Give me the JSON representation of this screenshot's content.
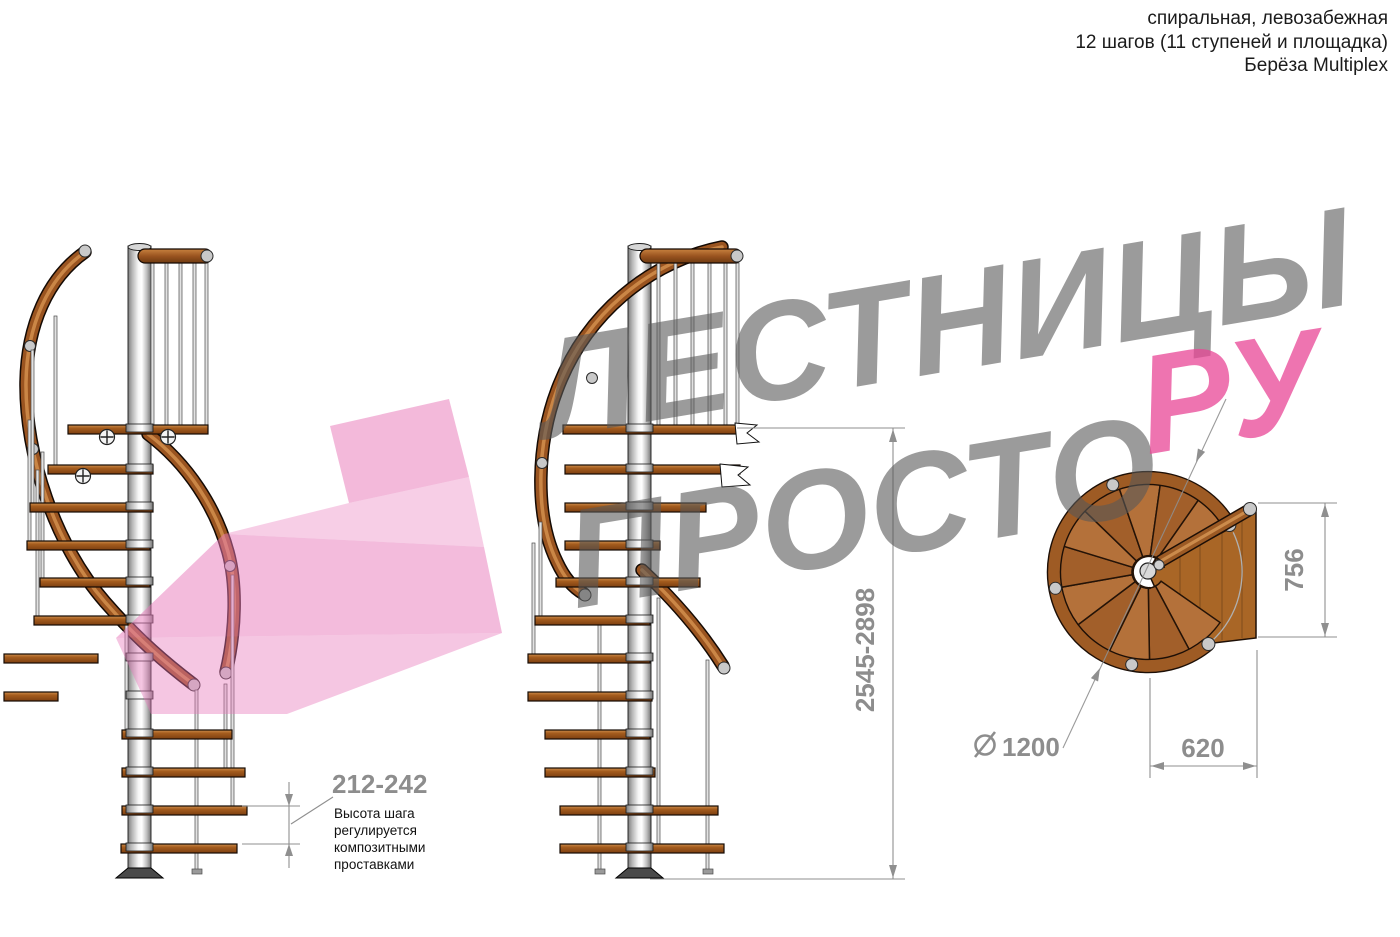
{
  "page": {
    "width": 1400,
    "height": 937,
    "background": "#ffffff"
  },
  "header": {
    "lines": [
      "спиральная, левозабежная",
      "12 шагов (11 ступеней и площадка)",
      "Берёза Multiplex"
    ]
  },
  "watermark": {
    "word1": "ЛЕСТНИЦЫ",
    "word2": "ПРОСТО",
    "word3": "РУ",
    "gray_color": "#9a9a9a",
    "pink_color": "#ee58a2",
    "arrow_color": "#e878b9"
  },
  "dimensions": {
    "step_height": "212-242",
    "step_note": [
      "Высота шага",
      "регулируется",
      "композитными",
      "проставками"
    ],
    "total_height": "2545-2898",
    "plan_depth": "756",
    "plan_width": "620",
    "diameter": "1200"
  },
  "colors": {
    "wood_light": "#b4713a",
    "wood_dark": "#a25f2a",
    "rail_brown": "#9a5420",
    "metal_gray": "#c9c9c9",
    "dimension_gray": "#8d8d8d",
    "note_black": "#111111"
  }
}
